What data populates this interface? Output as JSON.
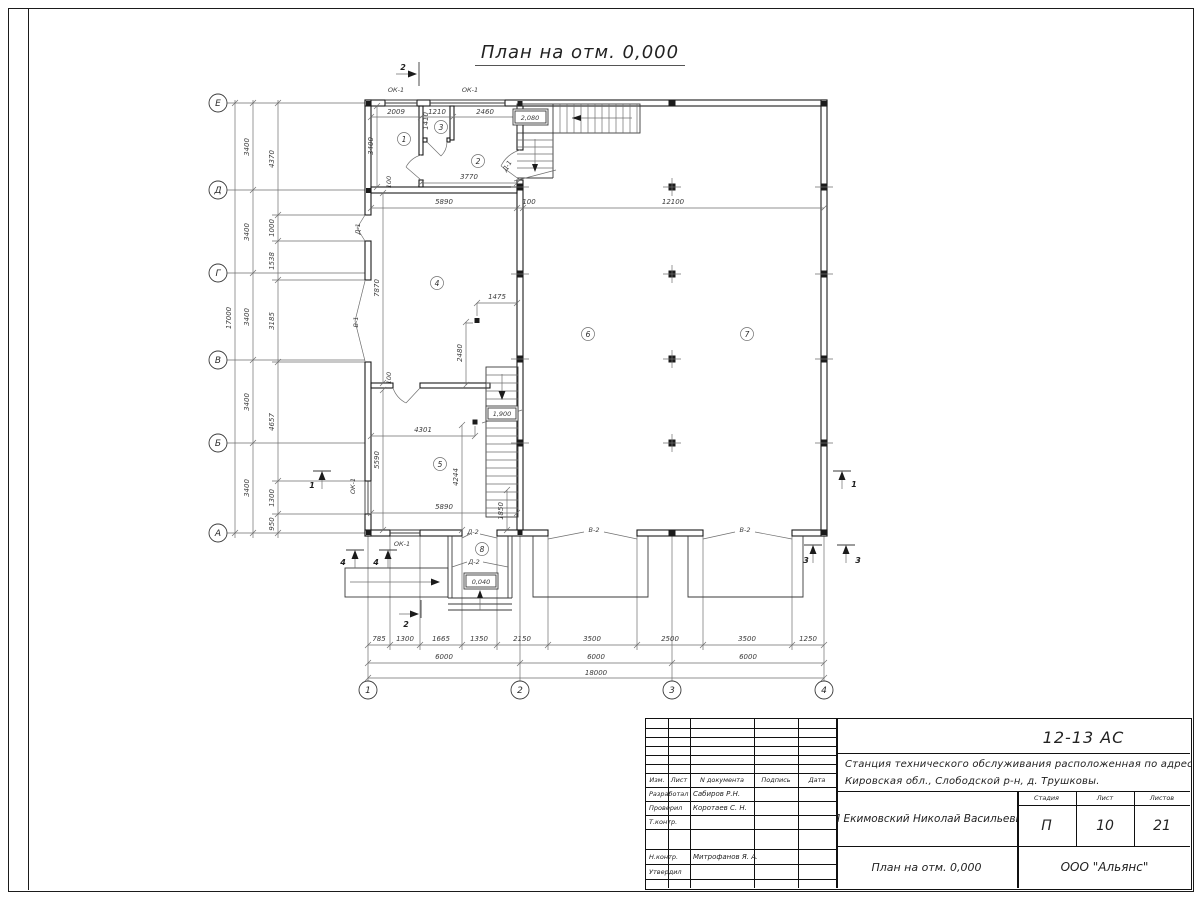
{
  "title": "План на отм. 0,000",
  "axes": {
    "left": [
      "Е",
      "Д",
      "Г",
      "В",
      "Б",
      "А"
    ],
    "bottom": [
      "1",
      "2",
      "3",
      "4"
    ]
  },
  "dims": {
    "left_total": "17000",
    "left_axes": [
      "3400",
      "3400",
      "3400",
      "3400",
      "3400"
    ],
    "left_inner": [
      "4370",
      "1000",
      "1538",
      "3185",
      "4657",
      "1300",
      "950"
    ],
    "bottom_detail": [
      "785",
      "1300",
      "1665",
      "1350",
      "2150",
      "3500",
      "2500",
      "3500",
      "1250"
    ],
    "bottom_axes": [
      "6000",
      "6000",
      "6000"
    ],
    "bottom_total": "18000",
    "top": [
      "2009",
      "1410",
      "1210",
      "2460"
    ],
    "mid": [
      "5890",
      "100",
      "12100"
    ],
    "r1_h": "3400",
    "r1_100": "100",
    "r2_w": "3770",
    "r4_h": "7870",
    "r4_1475": "1475",
    "r4_2480": "2480",
    "r4_100": "100",
    "r5_4301": "4301",
    "r5_5590": "5590",
    "r5_4244": "4244",
    "r5_5890": "5890",
    "r5_1850": "1850"
  },
  "marks": {
    "elev_2080": "2,080",
    "elev_1900": "1,900",
    "elev_0040": "0,040"
  },
  "labels": {
    "ok1": "ОК-1",
    "d1": "Д-1",
    "v1": "В-1",
    "d2": "Д-2",
    "v2": "В-2"
  },
  "sections": {
    "s1": "1",
    "s2": "2",
    "s3": "3",
    "s4": "4"
  },
  "rooms": [
    "1",
    "2",
    "3",
    "4",
    "5",
    "6",
    "7",
    "8"
  ],
  "stamp": {
    "doc_code": "12-13 АС",
    "object_line1": "Станция технического обслуживания расположенная по адресу",
    "object_line2": "Кировская обл., Слободской р-н, д. Трушковы.",
    "client": "ИП Екимовский Николай Васильевич",
    "drawing_title": "План на отм. 0,000",
    "company": "ООО \"Альянс\"",
    "col_izm": "Изм.",
    "col_list": "Лист",
    "col_ndoc": "N документа",
    "col_podp": "Подпись",
    "col_data": "Дата",
    "role_dev": "Разработал",
    "role_check": "Проверил",
    "role_tcontr": "Т.контр.",
    "role_ncontr": "Н.контр.",
    "role_approve": "Утвердил",
    "name_dev": "Сабиров Р.Н.",
    "name_check": "Коротаев С. Н.",
    "name_ncontr": "Митрофанов Я. А.",
    "stage_label": "Стадия",
    "sheet_label": "Лист",
    "sheets_label": "Листов",
    "stage": "П",
    "sheet_no": "10",
    "sheets_total": "21"
  }
}
